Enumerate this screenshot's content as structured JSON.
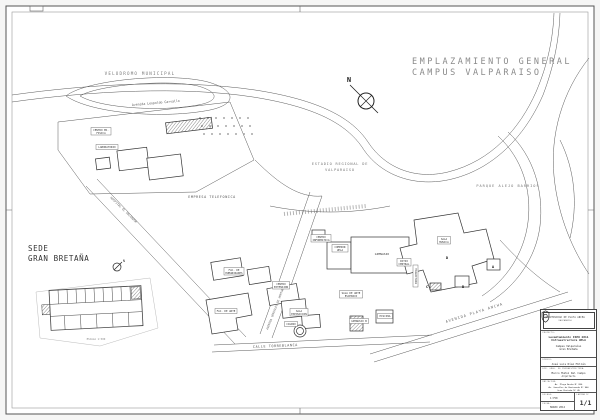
{
  "sheet": {
    "title_line1": "EMPLAZAMIENTO GENERAL",
    "title_line2": "CAMPUS VALPARAISO",
    "north_label": "N",
    "inset": {
      "heading_line1": "SEDE",
      "heading_line2": "GRAN BRETAÑA",
      "north_label": "N",
      "caption": "ESCALA 1:500"
    },
    "map_labels": {
      "velodromo": "VELODROMO MUNICIPAL",
      "avenida_carvallo": "Avenida Leopoldo Carvallo",
      "hospital": "HOSPITAL EL SALVADOR",
      "empresa": "EMPRESA TELEFONICA",
      "estadio_l1": "ESTADIO REGIONAL DE",
      "estadio_l2": "VALPARAISO",
      "parque": "PARQUE ALEJO BARRIOS",
      "gonzalez": "AVENIDA GONZALEZ DE HONTANEDA",
      "avenida_playa_ancha": "AVENIDA PLAYA ANCHA",
      "calle": "CALLE TORREBLANCA"
    },
    "building_labels": [
      {
        "l1": "CENTRO ED.",
        "l2": "FISICA"
      },
      {
        "l1": "LABORATORIO",
        "l2": ""
      },
      {
        "l1": "CENTRO",
        "l2": "INFORMATICA"
      },
      {
        "l1": "COMEDOR",
        "l2": "UPLA"
      },
      {
        "l1": "GIMNASIO",
        "l2": ""
      },
      {
        "l1": "SALA",
        "l2": "MUSICA"
      },
      {
        "l1": "PATIO",
        "l2": "CENTRAL"
      },
      {
        "l1": "BIBLIOTECA",
        "l2": ""
      },
      {
        "l1": "SALA DE ARTE",
        "l2": "ESCENICO"
      },
      {
        "l1": "CENTRO",
        "l2": "EXTENSION"
      },
      {
        "l1": "FAC. DE",
        "l2": "HUMANIDADES"
      },
      {
        "l1": "FAC. DE ARTE",
        "l2": ""
      },
      {
        "l1": "SALA",
        "l2": "EXPOSICION"
      },
      {
        "l1": "CASINO",
        "l2": ""
      },
      {
        "l1": "GIMNASIO B",
        "l2": ""
      },
      {
        "l1": "PISCINA",
        "l2": ""
      }
    ],
    "building_marks": [
      "A",
      "B",
      "C",
      "D"
    ],
    "titleblock": {
      "university": "UNIVERSIDAD DE PLAYA ANCHA",
      "university_sub": "VALPARAISO",
      "proyecto_label": "PROYECTO:",
      "proyecto_line1": "Levantamiento ISEO 2011",
      "proyecto_line2": "Infraestructura UPLA",
      "proyecto_line3": "Campus Valparaíso",
      "proyecto_line4": "Gran Bretaña",
      "dibujo_label": "DIBUJO:",
      "dibujo_value": "José Luis Díaz Millán",
      "dir_label": "DIR. GRAL. DE INFRAESTRUCTURA:",
      "dir_value1": "Marco Muñoz Del Campo",
      "dir_value2": "Arquitecto",
      "ubicacion_label": "UBICACION:",
      "ubicacion_line1": "Av. Playa Ancha N° 850",
      "ubicacion_line2": "Av. González de Hontaneda N° 960",
      "ubicacion_line3": "Gran Bretaña N° 45",
      "escala_label": "ESCALA:",
      "escala_value": "1:750",
      "fecha_label": "FECHA:",
      "fecha_value": "MARZO 2012",
      "lamina_label": "LAMINA N°",
      "lamina_value": "1/1"
    }
  }
}
